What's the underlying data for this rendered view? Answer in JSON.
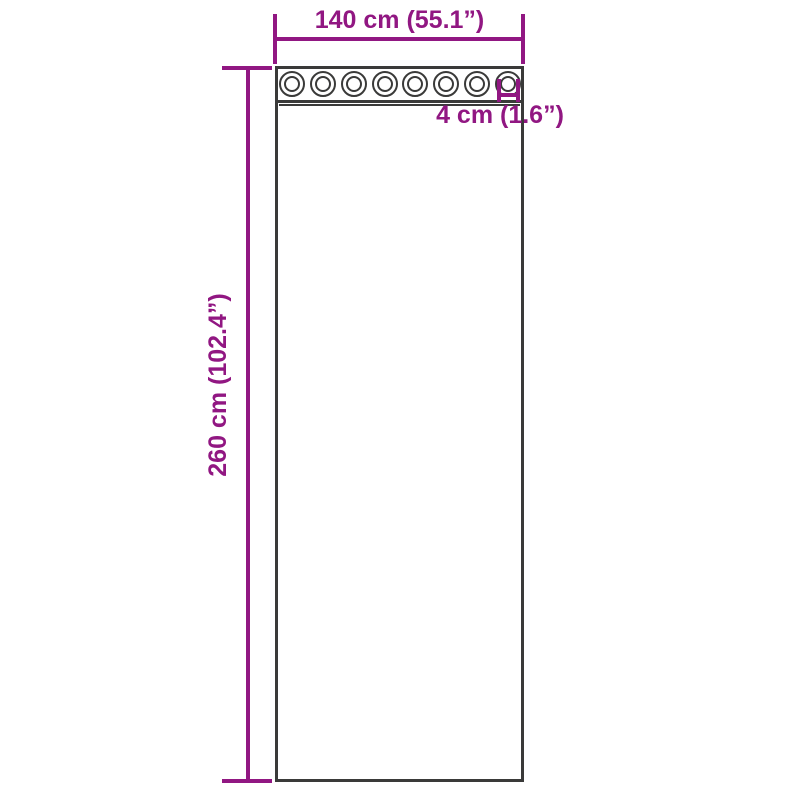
{
  "diagram": {
    "labels": {
      "width": "140 cm (55.1”)",
      "height": "260 cm (102.4”)",
      "grommet_diameter": "4 cm (1.6”)"
    },
    "grommet_count": 8,
    "colors": {
      "dimension_accent": "#911782",
      "outline": "#3a3a39",
      "background": "#ffffff"
    }
  }
}
